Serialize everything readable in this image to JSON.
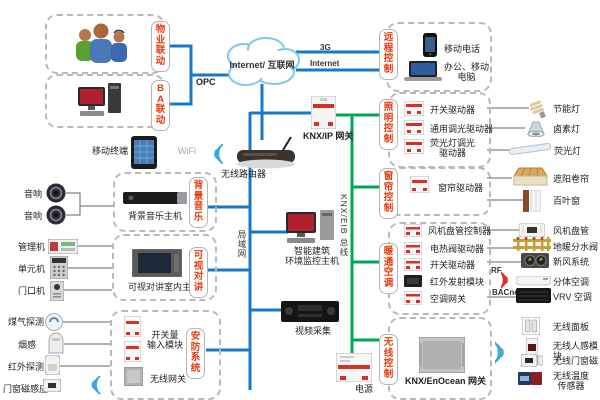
{
  "colors": {
    "lan_blue": "#1778c8",
    "knx_green": "#00a651",
    "tag_red": "#e8380d",
    "wifi_blue": "#3aa8dc",
    "rf_red": "#d93025"
  },
  "left": {
    "property_tag": "物业联动",
    "ba_tag": "BA联动",
    "opc": "OPC",
    "mobile_terminal": "移动终端",
    "wifi": "WiFi",
    "speaker_a": "音响",
    "speaker_b": "音响",
    "bgm_tag": "背景音乐",
    "bgm_host": "背景音乐主机",
    "mgr": "管理机",
    "unit": "单元机",
    "door": "门口机",
    "intercom_tag": "可视对讲",
    "intercom_host": "可视对讲室内主机",
    "gas": "煤气探测",
    "smoke": "烟感",
    "infrared": "红外探测",
    "door_magnet": "门窗磁感应",
    "security_tag": "安防系统",
    "input_module": "开关量\n输入模块",
    "wireless_gw": "无线网关"
  },
  "center": {
    "cloud": "Internet/ 互联网",
    "g3": "3G",
    "internet": "Internet",
    "router": "无线路由器",
    "knx_ip_gw": "KNX/IP 网关",
    "lan": "局域网",
    "bus": "KNX/EIB 总线",
    "monitor_host": "智能建筑\n环境监控主机",
    "video": "视频采集",
    "power": "电源"
  },
  "right": {
    "remote_tag": "远程控制",
    "phone": "移动电话",
    "pc": "办公、移动\n电脑",
    "lighting_tag": "照明控制",
    "sw_driver": "开关驱动器",
    "dim_driver": "通用调光驱动器",
    "fl_driver": "荧光灯调光\n驱动器",
    "energy_lamp": "节能灯",
    "halogen_lamp": "卤素灯",
    "fl_lamp": "荧光灯",
    "curtain_tag": "窗帘控制",
    "curtain_driver": "窗帘驱动器",
    "awning": "遮阳卷帘",
    "blind": "百叶窗",
    "hvac_tag": "暖通空调",
    "fcu_ctrl": "风机盘管控制器",
    "valve_driver": "电热阀驱动器",
    "sw_driver2": "开关驱动器",
    "ir_module": "红外发射模块",
    "ac_gw": "空调网关",
    "fcu": "风机盘管",
    "manifold": "地暖分水阀",
    "fresh_air": "新风系统",
    "rf": "RF",
    "split_ac": "分体空调",
    "bacnet": "BACnet",
    "vrv": "VRV 空调",
    "wireless_tag": "无线控制",
    "enocean_gw": "KNX/EnOcean 网关",
    "w_panel": "无线面板",
    "w_motion": "无线人感模块",
    "w_magnet": "无线门窗磁",
    "w_temp": "无线温度\n传感器"
  }
}
